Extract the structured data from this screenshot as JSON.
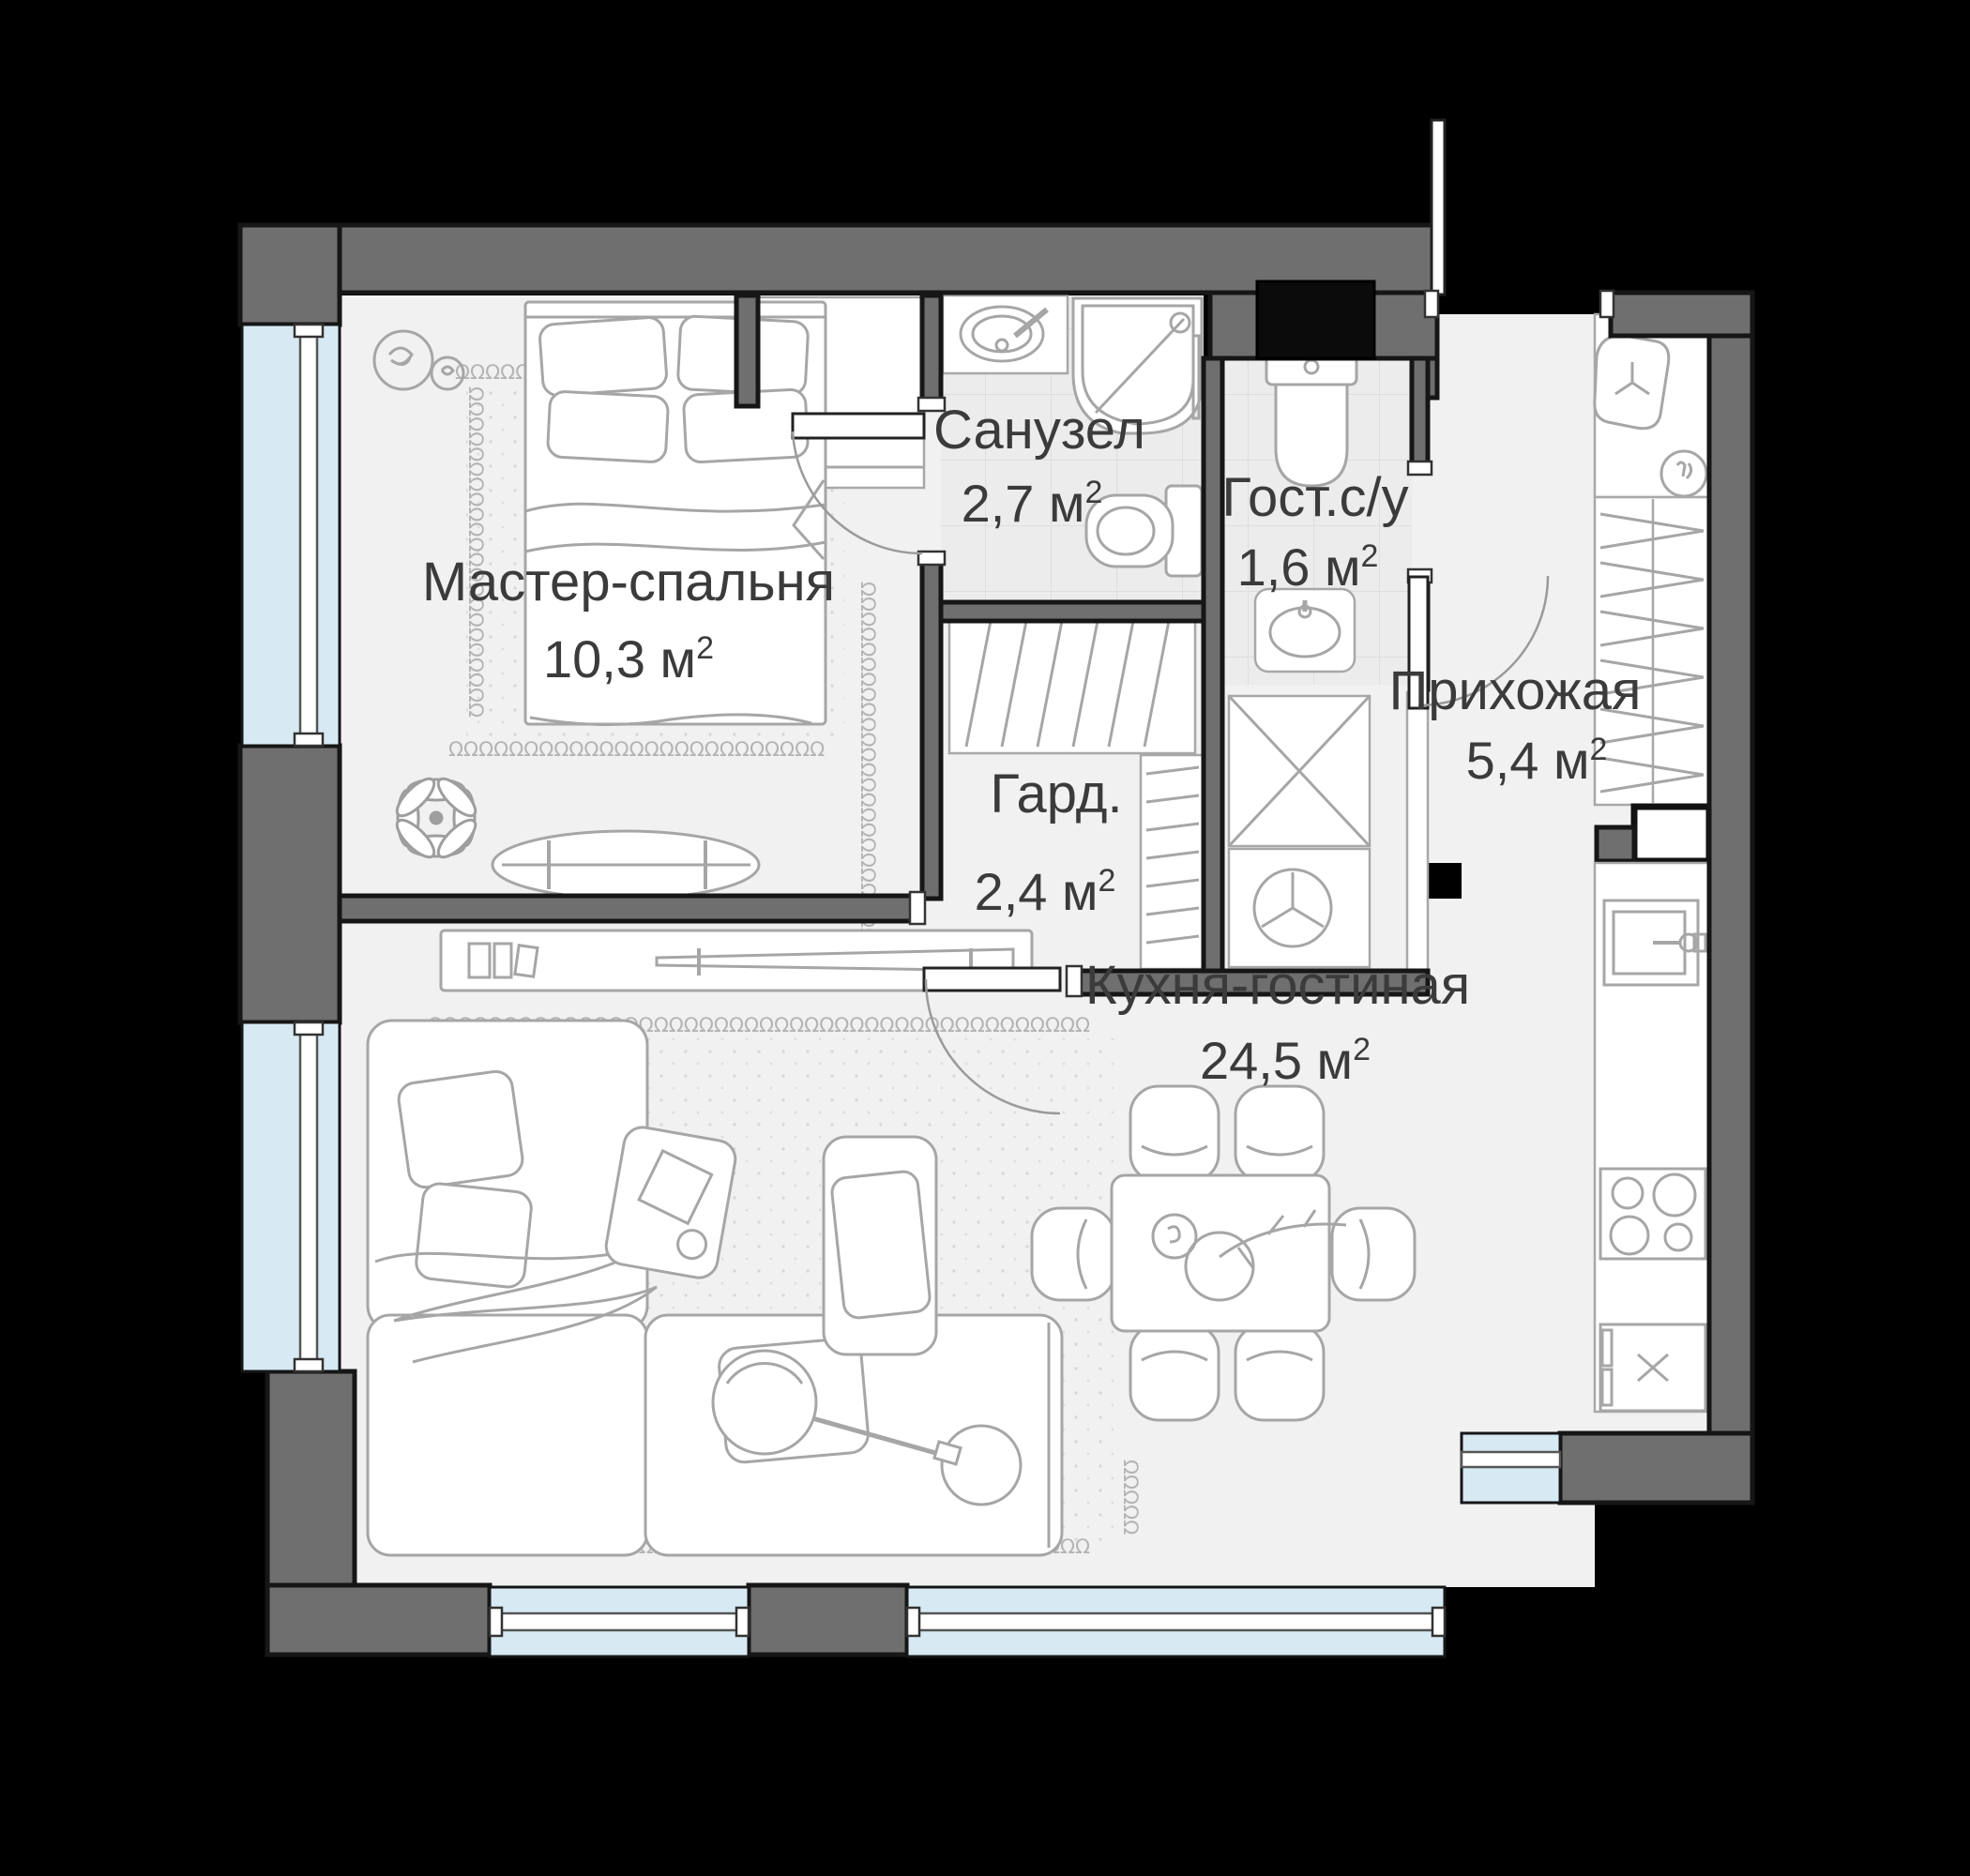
{
  "rooms": [
    {
      "id": "master-bedroom",
      "name": "Мастер-спальня",
      "area": "10,3 м²",
      "area_main": "10,3 м",
      "area_sup": "2"
    },
    {
      "id": "bathroom",
      "name": "Санузел",
      "area": "2,7 м²",
      "area_main": "2,7 м",
      "area_sup": "2"
    },
    {
      "id": "guest-wc",
      "name": "Гост.с/у",
      "area": "1,6 м²",
      "area_main": "1,6 м",
      "area_sup": "2"
    },
    {
      "id": "hallway",
      "name": "Прихожая",
      "area": "5,4 м²",
      "area_main": "5,4 м",
      "area_sup": "2"
    },
    {
      "id": "wardrobe",
      "name": "Гард.",
      "area": "2,4 м²",
      "area_main": "2,4 м",
      "area_sup": "2"
    },
    {
      "id": "kitchen-living",
      "name": "Кухня-гостиная",
      "area": "24,5 м²",
      "area_main": "24,5 м",
      "area_sup": "2"
    }
  ],
  "decor": {
    "loop_char": "Ω"
  },
  "colors": {
    "canvas": "#000000",
    "wall": "#6f6f6f",
    "wall_outline": "#161616",
    "floor": "#f1f1f1",
    "tile_floor": "#ececec",
    "tile_line": "#dedede",
    "window_glass": "#d7eaf4",
    "furniture_stroke": "#a6a6a6",
    "label_text": "#3b3b3b",
    "shaft": "#0b0b0b",
    "loop_decor": "#b4b4b4"
  }
}
